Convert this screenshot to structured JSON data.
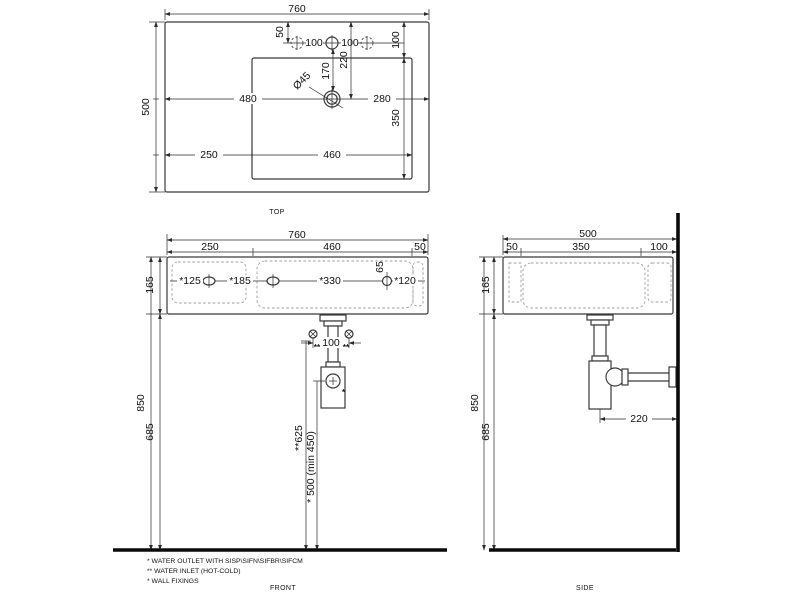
{
  "drawing": {
    "views": {
      "top": {
        "label": "TOP",
        "dims": {
          "width": "760",
          "depth": "500",
          "hole_edge": "50",
          "pitch_left": "100",
          "pitch_right": "100",
          "inset_right": "100",
          "drain_from_holes": "170",
          "drain_from_top": "220",
          "drain_diameter": "Ø45",
          "left_to_drain": "480",
          "drain_to_right": "280",
          "shelf": "250",
          "bowl_width": "460",
          "bowl_depth": "350"
        }
      },
      "front": {
        "label": "FRONT",
        "dims": {
          "width": "760",
          "shelf": "250",
          "bowl_width": "460",
          "right_edge": "50",
          "height": "165",
          "fix1": "*125",
          "fix2": "*185",
          "fix3": "*330",
          "fix4": "*120",
          "fix_drop": "65",
          "inlet_pitch": "100",
          "inlet_mark_left": "**",
          "inlet_mark_right": "**",
          "rim_height": "850",
          "underside_height": "685",
          "inlet_height": "**625",
          "outlet_height": "* 500 (min 450)",
          "outlet_mark": "*"
        }
      },
      "side": {
        "label": "SIDE",
        "dims": {
          "depth": "500",
          "front_lip": "50",
          "bowl_depth": "350",
          "back_inset": "100",
          "height": "165",
          "rim_height": "850",
          "underside_height": "685",
          "trap_to_wall": "220"
        }
      }
    },
    "notes": [
      "* WATER OUTLET WITH SISP\\SIFN\\SIFBR\\SIFCM",
      "** WATER INLET  (HOT-COLD)",
      "* WALL FIXINGS"
    ],
    "colors": {
      "line": "#3a3a3a",
      "heavy": "#0a0a0a",
      "background": "#ffffff"
    }
  }
}
